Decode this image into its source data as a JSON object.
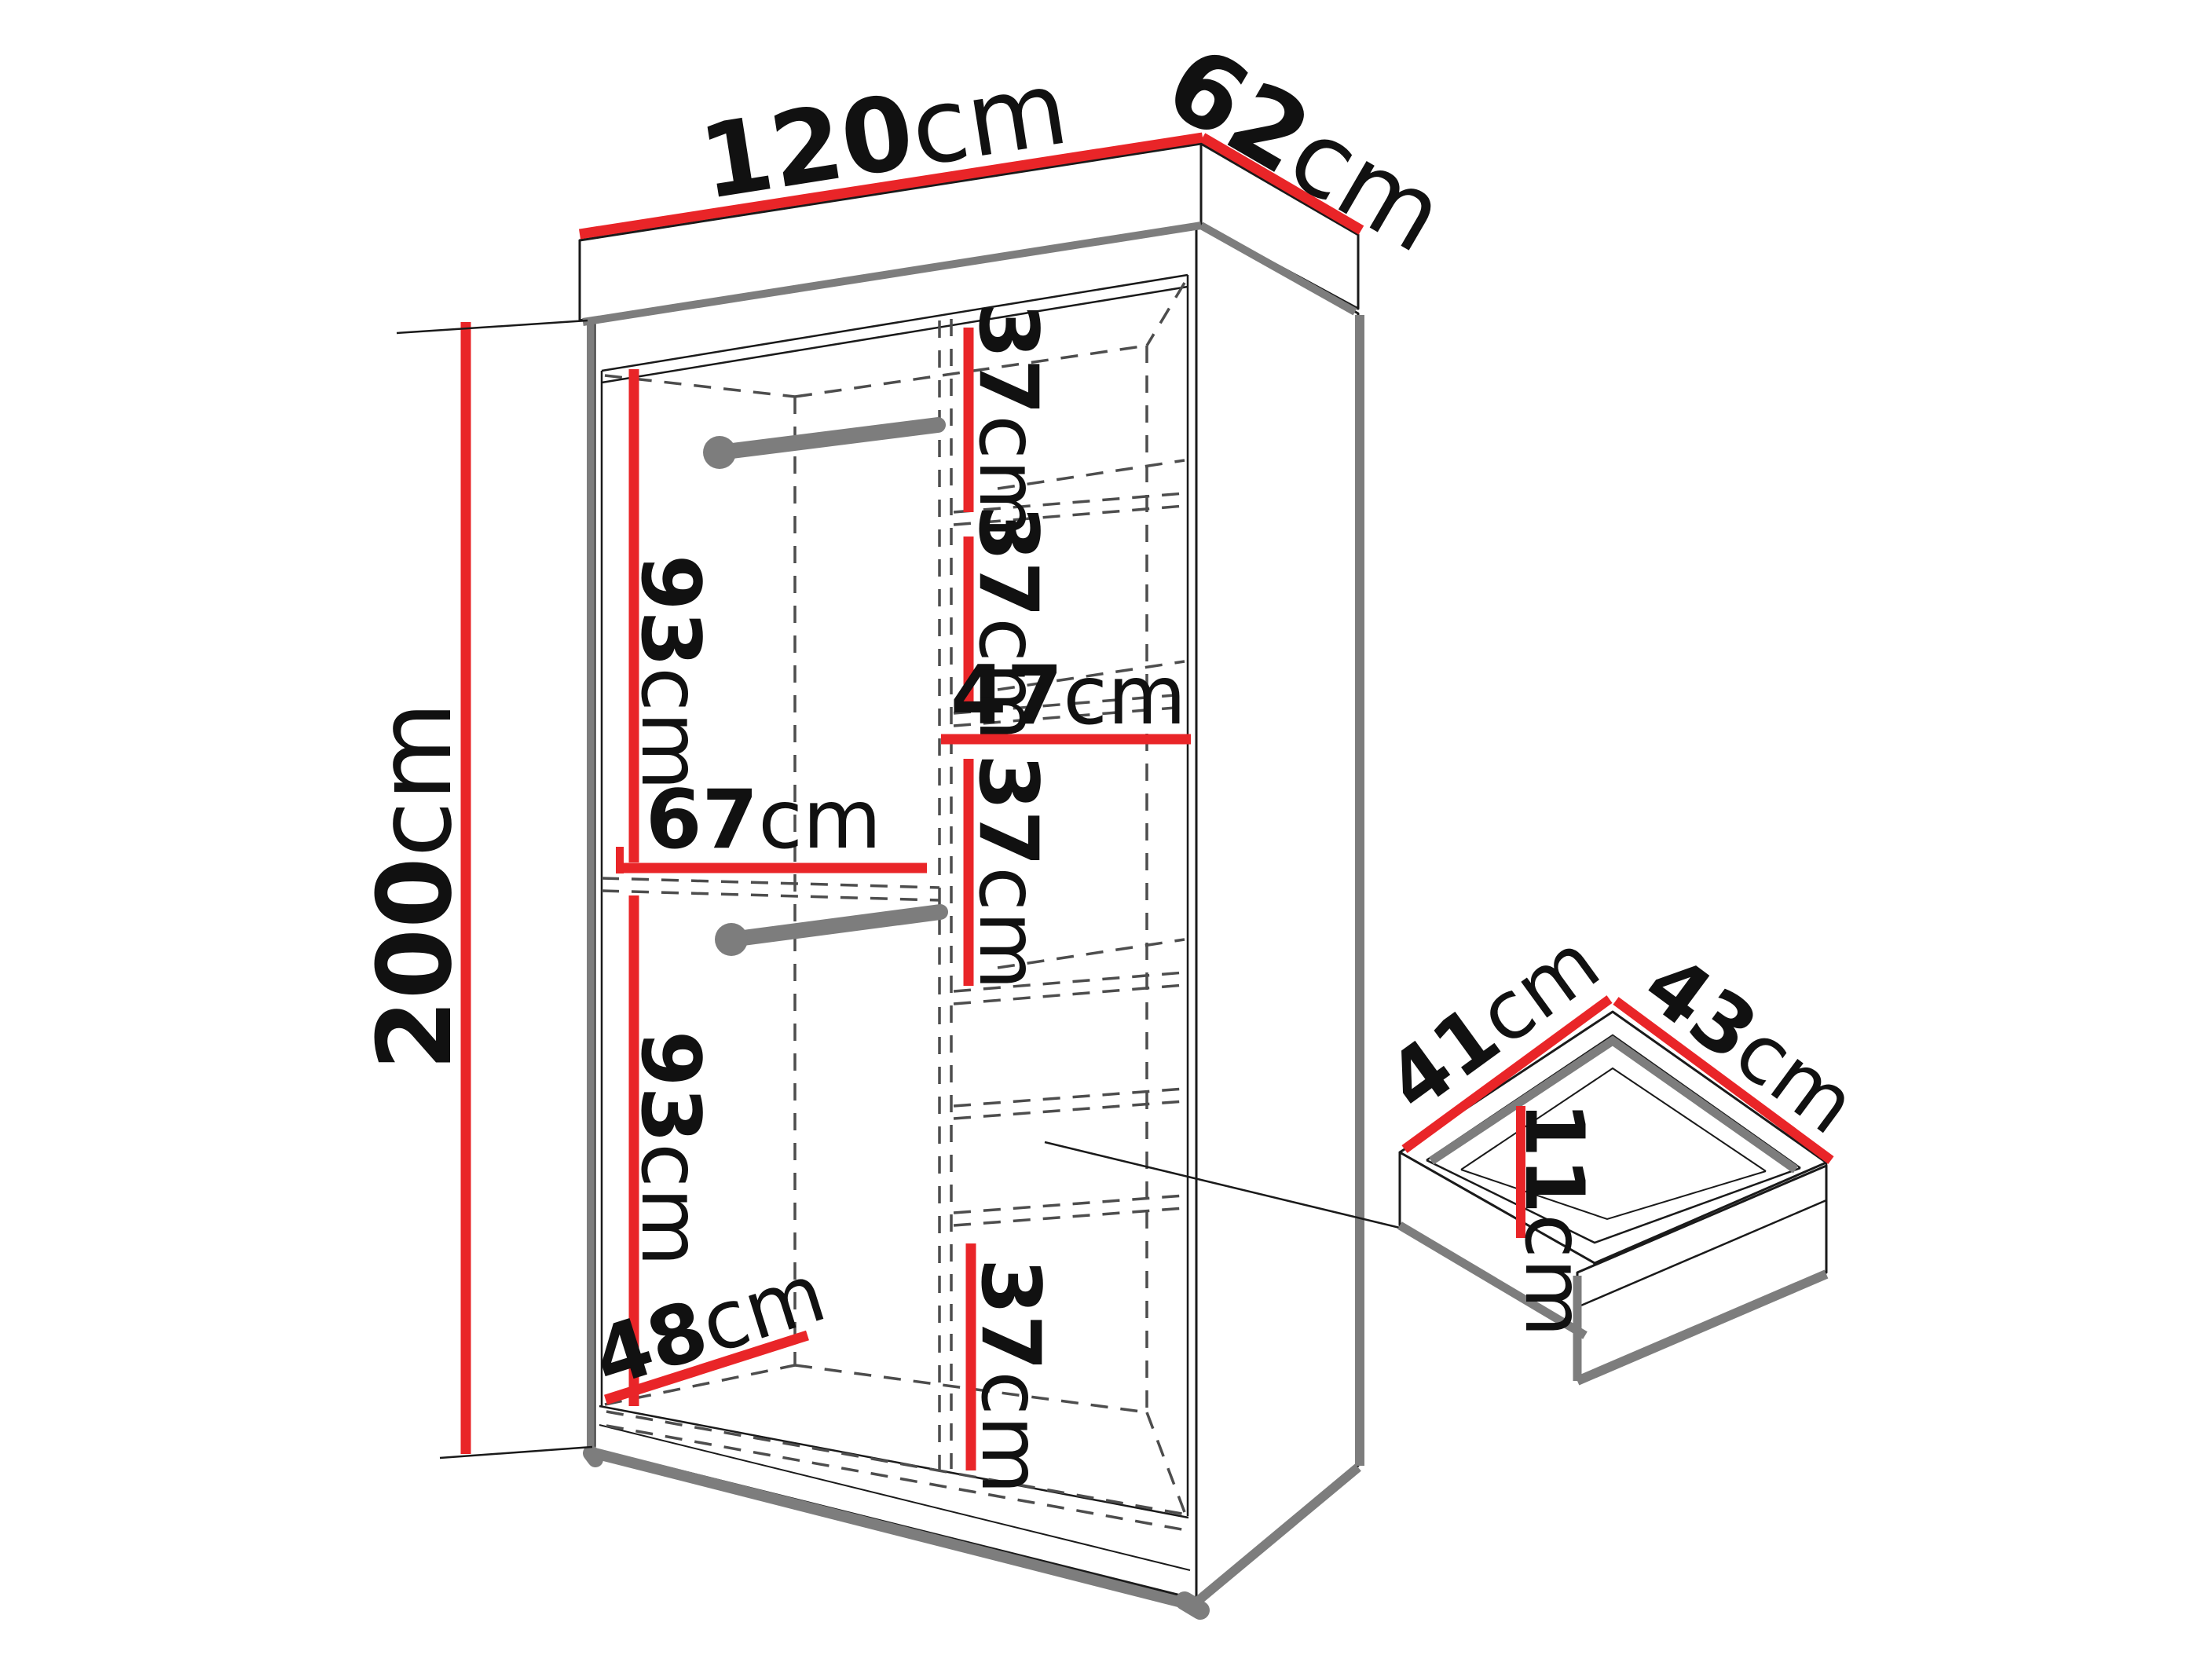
{
  "diagram": {
    "title": "wardrobe dimensions technical diagram",
    "unit": "cm",
    "colors": {
      "dimension-red": "#e92528",
      "edge-gray": "#7d7d7d",
      "dash-gray": "#4d4d4d",
      "line-black": "#1a1a1a",
      "background": "#ffffff"
    },
    "wardrobe": {
      "overall_width": {
        "num": "120",
        "unit": "cm"
      },
      "overall_depth": {
        "num": "62",
        "unit": "cm"
      },
      "overall_height": {
        "num": "200",
        "unit": "cm"
      },
      "interior": {
        "hanging_upper_height": {
          "num": "93",
          "unit": "cm"
        },
        "hanging_lower_height": {
          "num": "93",
          "unit": "cm"
        },
        "left_section_width": {
          "num": "67",
          "unit": "cm"
        },
        "shelf_width": {
          "num": "47",
          "unit": "cm"
        },
        "shelf_gap_1": {
          "num": "37",
          "unit": "cm"
        },
        "shelf_gap_2": {
          "num": "37",
          "unit": "cm"
        },
        "shelf_gap_3": {
          "num": "37",
          "unit": "cm"
        },
        "shelf_gap_4": {
          "num": "37",
          "unit": "cm"
        },
        "floor_depth": {
          "num": "48",
          "unit": "cm"
        }
      }
    },
    "drawer": {
      "side_length": {
        "num": "41",
        "unit": "cm"
      },
      "front_length": {
        "num": "43",
        "unit": "cm"
      },
      "inner_depth": {
        "num": "11",
        "unit": "cm"
      }
    }
  }
}
